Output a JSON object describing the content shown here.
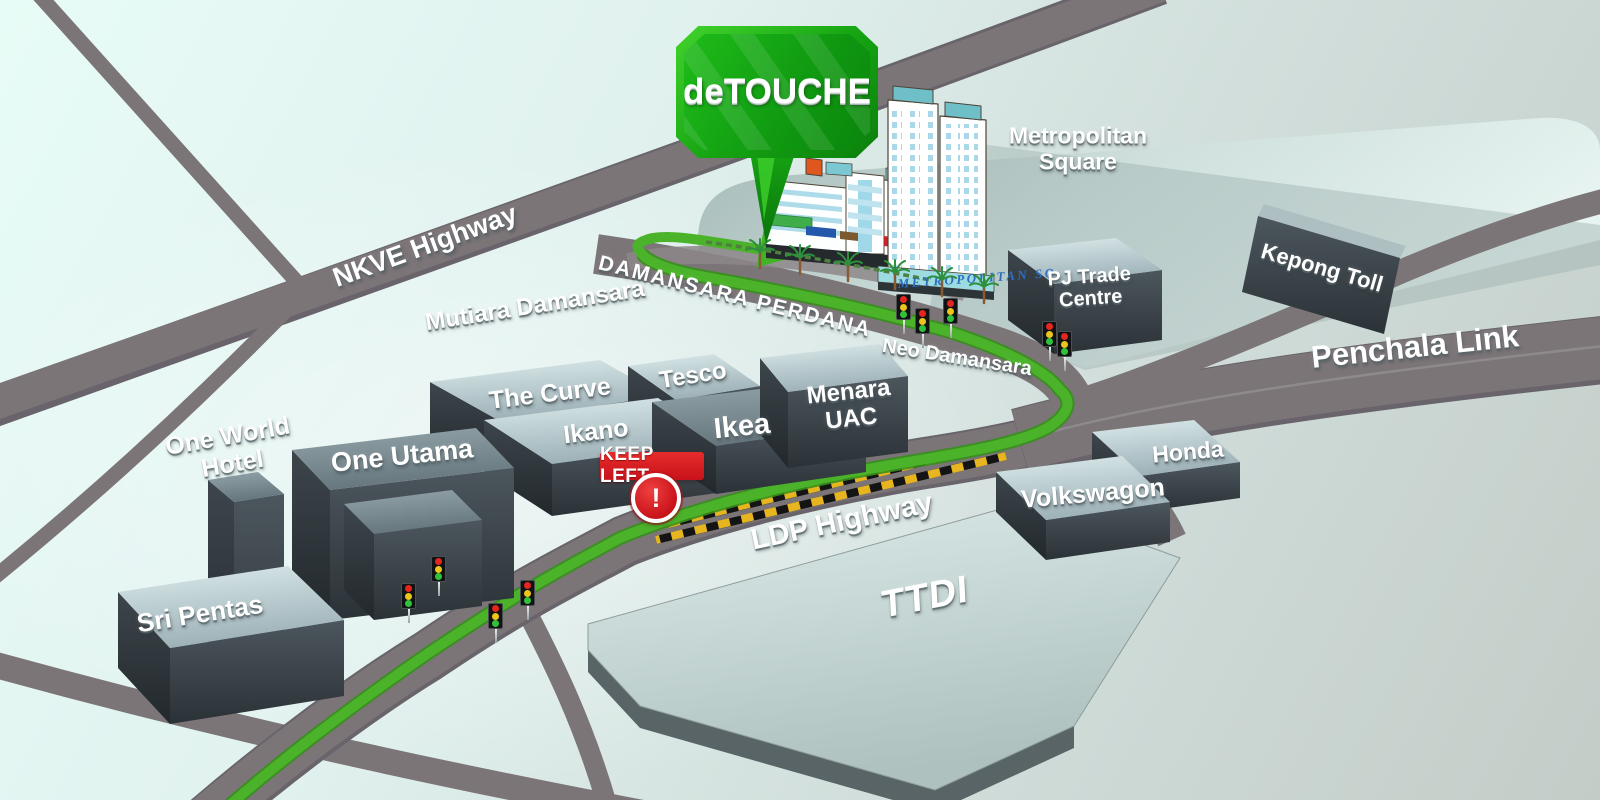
{
  "callout": {
    "text": "deTOUCHE"
  },
  "warning_sign": {
    "text": "KEEP LEFT",
    "mark": "!"
  },
  "roads": {
    "nkve": "NKVE Highway",
    "ldp": "LDP Highway",
    "penchala": "Penchala Link",
    "damansara_perdana": "DAMANSARA PERDANA",
    "neo_damansara": "Neo Damansara"
  },
  "areas": {
    "mutiara_damansara": "Mutiara Damansara",
    "ttdi": "TTDI"
  },
  "places": {
    "metropolitan_square": "Metropolitan Square",
    "metropolitan_sq_sign": "METROPOLITAN SQ",
    "pj_trade_centre": "PJ Trade Centre",
    "kepong_toll": "Kepong Toll",
    "the_curve": "The Curve",
    "ikano": "Ikano",
    "tesco": "Tesco",
    "ikea": "Ikea",
    "menara_uac": "Menara UAC",
    "honda": "Honda",
    "volkswagon": "Volkswagon",
    "one_world_hotel": "One World Hotel",
    "one_utama": "One Utama",
    "sri_pentas": "Sri Pentas"
  },
  "colors": {
    "route_green": "#4bb32a",
    "callout_green": "#17a614",
    "road_gray": "#7b7578",
    "sign_red": "#c8131a",
    "hazard_yellow": "#e7b520",
    "building_sign_blue": "#2c6fc0"
  }
}
